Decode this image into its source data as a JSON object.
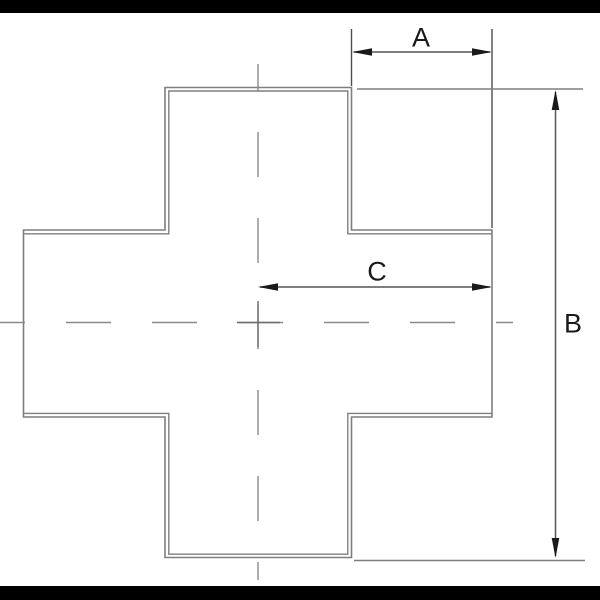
{
  "labels": {
    "dim_a": "A",
    "dim_b": "B",
    "dim_c": "C"
  },
  "colors": {
    "background": "#ffffff",
    "letterbox": "#000000",
    "outline": "#7f7f7f",
    "centerline": "#8a8a8a",
    "dimension": "#555555",
    "extension": "#4d4d4d",
    "arrow": "#1a1a1a",
    "text": "#1a1a1a"
  }
}
